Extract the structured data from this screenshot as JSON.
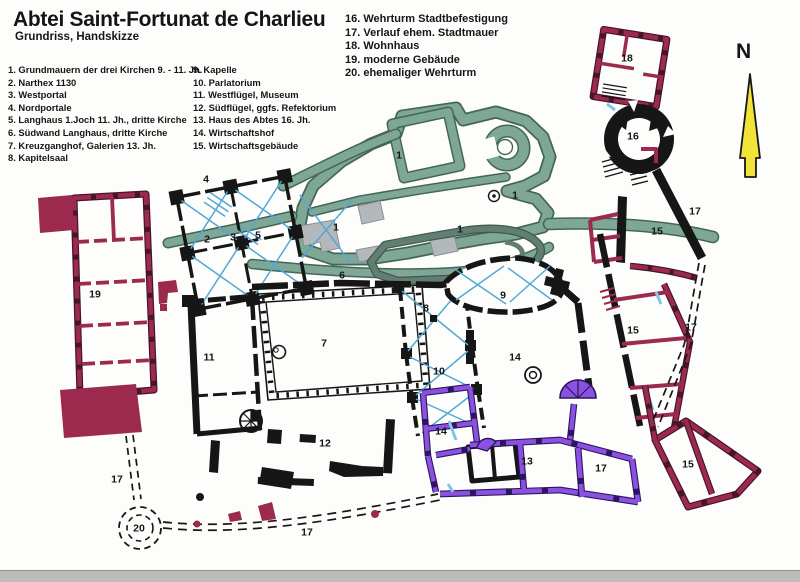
{
  "header": {
    "title": "Abtei Saint-Fortunat de Charlieu",
    "subtitle": "Grundriss, Handskizze"
  },
  "compass": {
    "label": "N"
  },
  "legend": {
    "col1": [
      "1. Grundmauern der drei Kirchen  9. - 11. Jh.",
      "2. Narthex 1130",
      "3. Westportal",
      "4. Nordportale",
      "5. Langhaus 1.Joch 11. Jh.,  dritte Kirche",
      "6. Südwand Langhaus, dritte Kirche",
      "7. Kreuzganghof, Galerien 13. Jh.",
      "8. Kapitelsaal"
    ],
    "col2": [
      " 9. Kapelle",
      "10.  Parlatorium",
      "11. Westflügel, Museum",
      "12. Südflügel, ggfs. Refektorium",
      "13. Haus des Abtes 16. Jh.",
      "14. Wirtschaftshof",
      "15. Wirtschaftsgebäude"
    ],
    "col3": [
      "16. Wehrturm Stadtbefestigung",
      "17. Verlauf ehem. Stadtmauer",
      "18. Wohnhaus",
      "19. moderne Gebäude",
      "20. ehemaliger Wehrturm"
    ]
  },
  "plan_labels": [
    {
      "n": "1",
      "x": 399,
      "y": 156
    },
    {
      "n": "1",
      "x": 515,
      "y": 196
    },
    {
      "n": "1",
      "x": 336,
      "y": 228
    },
    {
      "n": "1",
      "x": 460,
      "y": 230
    },
    {
      "n": "2",
      "x": 207,
      "y": 240
    },
    {
      "n": "3",
      "x": 233,
      "y": 238
    },
    {
      "n": "4",
      "x": 206,
      "y": 180
    },
    {
      "n": "5",
      "x": 258,
      "y": 236
    },
    {
      "n": "6",
      "x": 342,
      "y": 276
    },
    {
      "n": "7",
      "x": 324,
      "y": 344
    },
    {
      "n": "8",
      "x": 426,
      "y": 309
    },
    {
      "n": "9",
      "x": 503,
      "y": 296
    },
    {
      "n": "10",
      "x": 439,
      "y": 372
    },
    {
      "n": "11",
      "x": 209,
      "y": 358
    },
    {
      "n": "12",
      "x": 325,
      "y": 444
    },
    {
      "n": "13",
      "x": 527,
      "y": 462
    },
    {
      "n": "14",
      "x": 515,
      "y": 358
    },
    {
      "n": "14",
      "x": 441,
      "y": 432
    },
    {
      "n": "15",
      "x": 657,
      "y": 232
    },
    {
      "n": "15",
      "x": 633,
      "y": 331
    },
    {
      "n": "15",
      "x": 688,
      "y": 465
    },
    {
      "n": "16",
      "x": 633,
      "y": 137
    },
    {
      "n": "17",
      "x": 695,
      "y": 212
    },
    {
      "n": "17",
      "x": 691,
      "y": 328
    },
    {
      "n": "17",
      "x": 601,
      "y": 469
    },
    {
      "n": "17",
      "x": 117,
      "y": 480
    },
    {
      "n": "17",
      "x": 307,
      "y": 533
    },
    {
      "n": "18",
      "x": 627,
      "y": 59
    },
    {
      "n": "19",
      "x": 95,
      "y": 295
    },
    {
      "n": "20",
      "x": 139,
      "y": 529
    }
  ],
  "colors": {
    "church_foundation_teal": "#7ea795",
    "current_church_teal": "#617e72",
    "modern_building_maroon": "#9c2a4e",
    "abbots_house_purple": "#8b51e0",
    "vault_rib_blue": "#52a8d6",
    "compass_yellow": "#f2e338",
    "wall_black": "#161616",
    "gray_patch": "#b3b8bc"
  }
}
